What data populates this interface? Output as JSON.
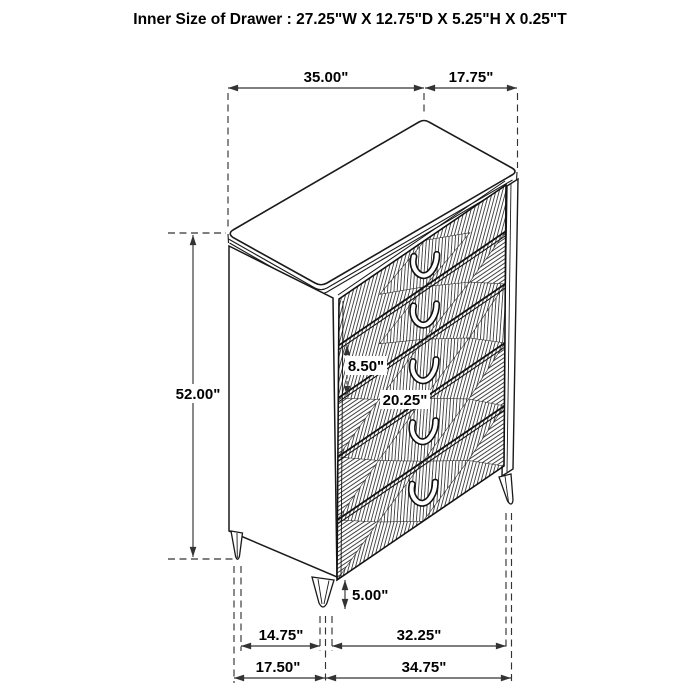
{
  "title": "Inner Size of Drawer : 27.25\"W X 12.75\"D X 5.25\"H X 0.25\"T",
  "dimensions": {
    "top_width": "35.00\"",
    "top_depth": "17.75\"",
    "overall_height": "52.00\"",
    "drawer_front_height": "8.50\"",
    "drawer_width": "20.25\"",
    "leg_height": "5.00\"",
    "front_leg_span_inner": "14.75\"",
    "side_leg_span_inner": "32.25\"",
    "front_leg_span_outer": "17.50\"",
    "side_leg_span_outer": "34.75\""
  },
  "colors": {
    "line": "#1a1a1a",
    "dim_line": "#333333",
    "hatch": "#2f2f2f",
    "background": "#ffffff"
  }
}
